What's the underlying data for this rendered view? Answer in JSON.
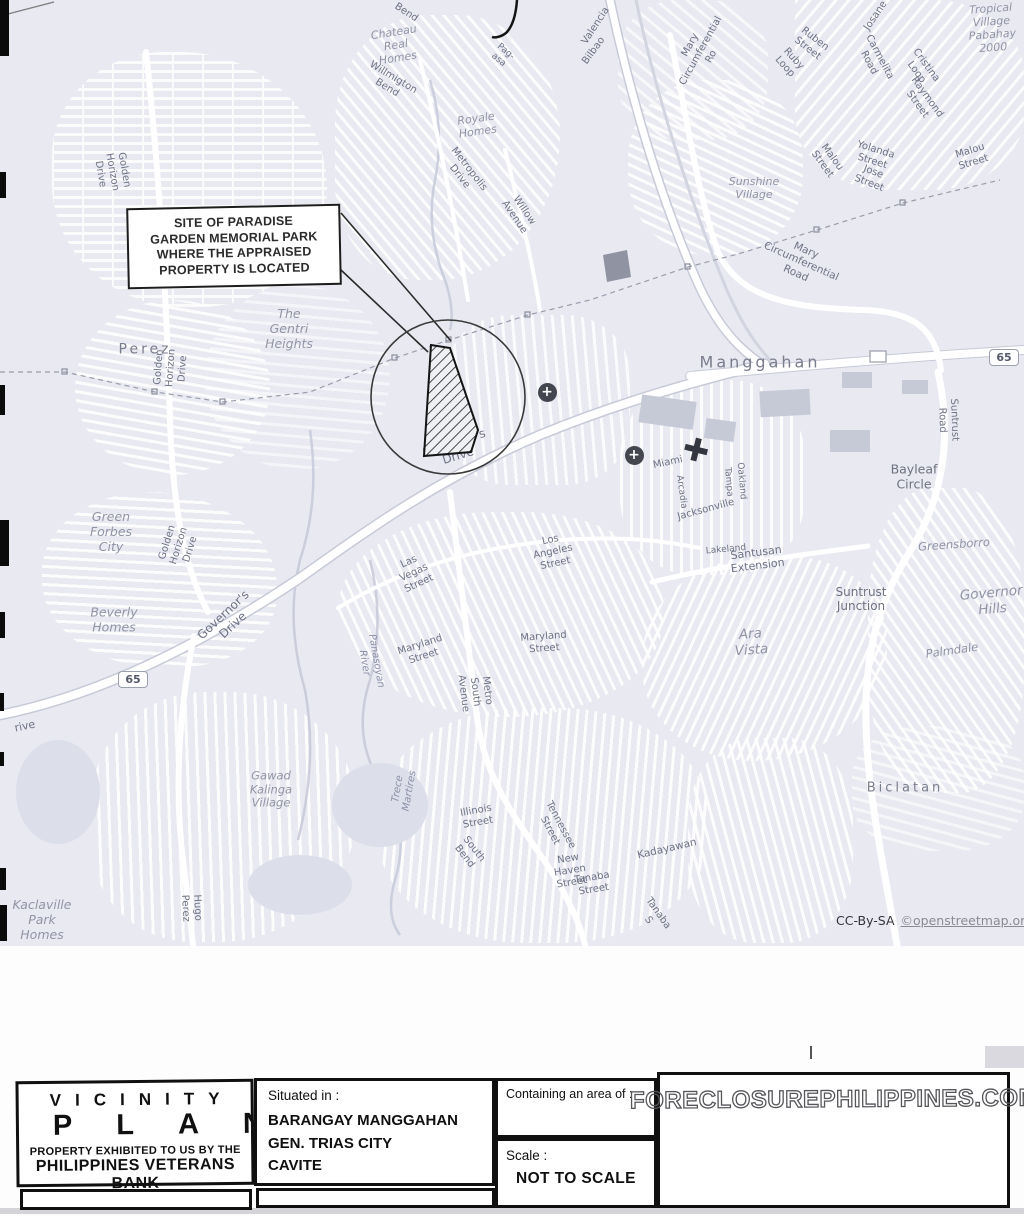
{
  "map": {
    "callout": {
      "text": "SITE OF PARADISE\nGARDEN MEMORIAL PARK\nWHERE THE APPRAISED\nPROPERTY IS LOCATED"
    },
    "attribution": {
      "cc": "CC-By-SA",
      "link": "©openstreetmap.org"
    },
    "route_shields": [
      {
        "label": "65",
        "x": 133,
        "y": 679
      },
      {
        "label": "65",
        "x": 1004,
        "y": 357
      }
    ],
    "hospital_markers": [
      {
        "x": 547,
        "y": 392
      },
      {
        "x": 634,
        "y": 455
      }
    ],
    "labels": [
      {
        "t": "Bend",
        "x": 406,
        "y": 13,
        "r": 33
      },
      {
        "t": "Pag-asa",
        "x": 502,
        "y": 56,
        "r": 40,
        "s": 9
      },
      {
        "t": "Chateau\nReal Homes",
        "x": 396,
        "y": 46,
        "r": -9,
        "c": "place",
        "s": 11
      },
      {
        "t": "Willmigton Bend",
        "x": 390,
        "y": 83,
        "r": 31
      },
      {
        "t": "Royale\nHomes",
        "x": 477,
        "y": 126,
        "r": -8,
        "c": "place",
        "s": 11
      },
      {
        "t": "Metropolis Drive",
        "x": 464,
        "y": 173,
        "r": 52
      },
      {
        "t": "Willow Avenue",
        "x": 519,
        "y": 214,
        "r": 56
      },
      {
        "t": "Valencia",
        "x": 596,
        "y": 26,
        "r": -57
      },
      {
        "t": "Bilbao",
        "x": 594,
        "y": 51,
        "r": -54
      },
      {
        "t": "Josane",
        "x": 876,
        "y": 16,
        "r": -56
      },
      {
        "t": "Ruben Street",
        "x": 811,
        "y": 44,
        "r": 38
      },
      {
        "t": "Ruby Loop",
        "x": 789,
        "y": 63,
        "r": 48
      },
      {
        "t": "Carmelita Road",
        "x": 874,
        "y": 60,
        "r": 62
      },
      {
        "t": "Cristina Loop",
        "x": 921,
        "y": 69,
        "r": 54
      },
      {
        "t": "Raymond Street",
        "x": 922,
        "y": 101,
        "r": 54
      },
      {
        "t": "Tropical\nVillage\nPabahay\n2000",
        "x": 992,
        "y": 29,
        "r": -4,
        "c": "place",
        "s": 11
      },
      {
        "t": "Malou Street",
        "x": 827,
        "y": 161,
        "r": 54
      },
      {
        "t": "Yolanda Street",
        "x": 874,
        "y": 156,
        "r": 17
      },
      {
        "t": "Jose Street",
        "x": 871,
        "y": 178,
        "r": 21
      },
      {
        "t": "Malou Street",
        "x": 972,
        "y": 157,
        "r": -17
      },
      {
        "t": "Sunshine\nVillage",
        "x": 754,
        "y": 189,
        "c": "place",
        "s": 11
      },
      {
        "t": "Mary Circumferential Ro",
        "x": 701,
        "y": 51,
        "r": -61,
        "s": 10
      },
      {
        "t": "Mary Circumferential Road",
        "x": 801,
        "y": 262,
        "r": 24,
        "s": 10.5
      },
      {
        "t": "Manggahan",
        "x": 760,
        "y": 363,
        "c": "area",
        "s": 16,
        "ls": 3
      },
      {
        "t": "Suntrust Road",
        "x": 948,
        "y": 420,
        "r": 88,
        "s": 10
      },
      {
        "t": "Bayleaf\nCircle",
        "x": 914,
        "y": 477,
        "c": "place2",
        "s": 12.5
      },
      {
        "t": "Greensborro",
        "x": 954,
        "y": 545,
        "r": -4,
        "c": "place",
        "s": 11.5
      },
      {
        "t": "Suntrust\nJunction",
        "x": 861,
        "y": 599,
        "c": "place2",
        "s": 12
      },
      {
        "t": "Governor\nHills",
        "x": 992,
        "y": 602,
        "r": -5,
        "c": "place",
        "s": 13.5
      },
      {
        "t": "Palmdale",
        "x": 952,
        "y": 651,
        "r": -8,
        "c": "place",
        "s": 11.5
      },
      {
        "t": "Ara Vista",
        "x": 751,
        "y": 643,
        "r": -4,
        "c": "place",
        "s": 13.5
      },
      {
        "t": "Miami",
        "x": 668,
        "y": 463,
        "r": -12
      },
      {
        "t": "Arcadia",
        "x": 681,
        "y": 492,
        "r": 82,
        "s": 9
      },
      {
        "t": "Tampa",
        "x": 728,
        "y": 482,
        "r": 85,
        "s": 9
      },
      {
        "t": "Oakland",
        "x": 741,
        "y": 481,
        "r": 85,
        "s": 9
      },
      {
        "t": "Jacksonville",
        "x": 706,
        "y": 510,
        "r": -15
      },
      {
        "t": "Lakeland",
        "x": 726,
        "y": 550,
        "r": -5,
        "s": 9
      },
      {
        "t": "Santusan Extension",
        "x": 757,
        "y": 560,
        "r": -7,
        "s": 11
      },
      {
        "t": "Perez",
        "x": 145,
        "y": 350,
        "c": "area",
        "s": 14,
        "ls": 3
      },
      {
        "t": "The Gentri\nHeights",
        "x": 289,
        "y": 329,
        "c": "place",
        "s": 12.5
      },
      {
        "t": "Golden Horizon Drive",
        "x": 112,
        "y": 172,
        "r": 80
      },
      {
        "t": "Golden Horizon Drive",
        "x": 171,
        "y": 368,
        "r": -86
      },
      {
        "t": "Golden Horizon Drive",
        "x": 179,
        "y": 546,
        "r": -73
      },
      {
        "t": "Governor's Drive",
        "x": 456,
        "y": 449,
        "r": -17,
        "s": 12
      },
      {
        "t": "Governor's Drive",
        "x": 228,
        "y": 620,
        "r": -43,
        "s": 12
      },
      {
        "t": "Green Forbes\nCity",
        "x": 111,
        "y": 532,
        "c": "place",
        "s": 12.5
      },
      {
        "t": "Beverly\nHomes",
        "x": 114,
        "y": 620,
        "c": "place",
        "s": 12.5
      },
      {
        "t": "Gawad\nKalinga\nVillage",
        "x": 271,
        "y": 790,
        "c": "place",
        "s": 11.5
      },
      {
        "t": "Hugo Perez",
        "x": 191,
        "y": 908,
        "r": 87,
        "s": 10
      },
      {
        "t": "Kaclaville\nPark Homes",
        "x": 42,
        "y": 920,
        "c": "place",
        "s": 12.5
      },
      {
        "t": "rive",
        "x": 25,
        "y": 727,
        "r": -12,
        "s": 11
      },
      {
        "t": "Panasoyan River",
        "x": 370,
        "y": 662,
        "r": 80,
        "c": "river"
      },
      {
        "t": "Trece Martires",
        "x": 404,
        "y": 790,
        "r": -80,
        "c": "river"
      },
      {
        "t": "Las Vegas Street",
        "x": 414,
        "y": 573,
        "r": -25
      },
      {
        "t": "Los Angeles Street",
        "x": 553,
        "y": 552,
        "r": -12
      },
      {
        "t": "Maryland Street",
        "x": 422,
        "y": 651,
        "r": -18
      },
      {
        "t": "Maryland Street",
        "x": 544,
        "y": 643,
        "r": -4
      },
      {
        "t": "Metro South Avenue",
        "x": 475,
        "y": 692,
        "r": 83
      },
      {
        "t": "Illinois Street",
        "x": 477,
        "y": 817,
        "r": -10
      },
      {
        "t": "South Bend",
        "x": 469,
        "y": 853,
        "r": 52
      },
      {
        "t": "Tennessee Street",
        "x": 555,
        "y": 828,
        "r": 62
      },
      {
        "t": "New Haven Street",
        "x": 570,
        "y": 871,
        "r": -9
      },
      {
        "t": "Tanaba Street",
        "x": 593,
        "y": 884,
        "r": -9
      },
      {
        "t": "Tanaba S",
        "x": 653,
        "y": 917,
        "r": 55
      },
      {
        "t": "Kadayawan",
        "x": 667,
        "y": 849,
        "r": -13,
        "s": 10.5
      },
      {
        "t": "Biclatan",
        "x": 905,
        "y": 788,
        "c": "area",
        "s": 13,
        "ls": 3
      }
    ]
  },
  "title_block": {
    "vicinity": "VICINITY",
    "plan": "PLAN",
    "exhibited": "PROPERTY EXHIBITED TO US BY THE",
    "bank": "PHILIPPINES VETERANS BANK",
    "situated_label": "Situated in :",
    "situated_lines": "BARANGAY MANGGAHAN\nGEN. TRIAS CITY\nCAVITE",
    "area_label": "Containing an area of :",
    "scale_label": "Scale :",
    "scale_value": "NOT TO SCALE",
    "watermark": "FORECLOSUREPHILIPPINES.COM"
  }
}
